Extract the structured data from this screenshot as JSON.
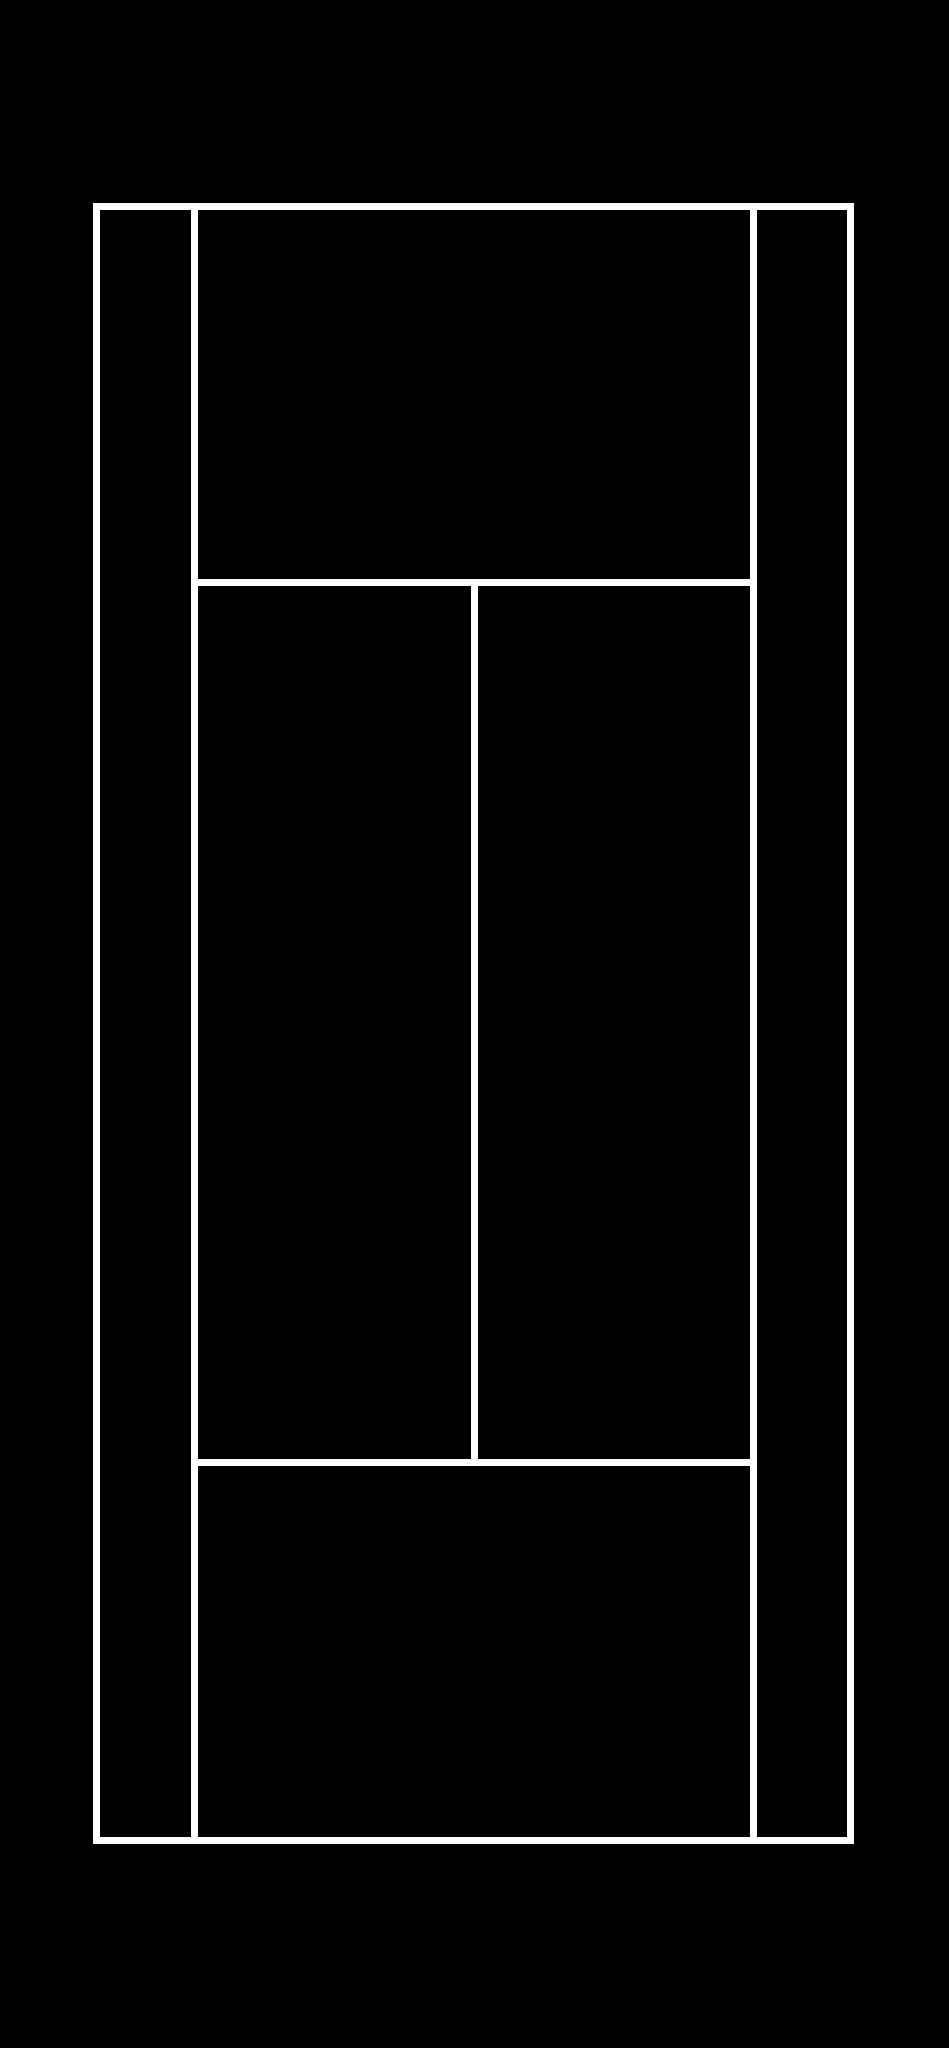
{
  "page": {
    "width": 949,
    "height": 2048,
    "background_color": "#000000"
  },
  "diagram": {
    "kind": "tennis-court-line-diagram",
    "description": "Top-down outline of a tennis court: white lines on a black background, no net line and no center marks",
    "line_color": "#ffffff",
    "line_thickness": 7,
    "court_bounds": {
      "outer_left_x": 93,
      "outer_right_x": 854,
      "outer_top_y": 203,
      "outer_bottom_y": 1844,
      "singles_sideline_left_x": 191,
      "singles_sideline_right_x": 750,
      "service_line_top_y": 579,
      "service_line_bottom_y": 1459,
      "center_service_line_x": 471
    },
    "lines": [
      {
        "name": "baseline-top",
        "x": 93,
        "y": 203,
        "w": 761,
        "h": 7
      },
      {
        "name": "baseline-bottom",
        "x": 93,
        "y": 1837,
        "w": 761,
        "h": 7
      },
      {
        "name": "doubles-sideline-left",
        "x": 93,
        "y": 203,
        "w": 7,
        "h": 1641
      },
      {
        "name": "doubles-sideline-right",
        "x": 847,
        "y": 203,
        "w": 7,
        "h": 1641
      },
      {
        "name": "singles-sideline-left",
        "x": 191,
        "y": 210,
        "w": 7,
        "h": 1627
      },
      {
        "name": "singles-sideline-right",
        "x": 750,
        "y": 210,
        "w": 7,
        "h": 1627
      },
      {
        "name": "service-line-top",
        "x": 198,
        "y": 579,
        "w": 552,
        "h": 7
      },
      {
        "name": "service-line-bottom",
        "x": 198,
        "y": 1459,
        "w": 552,
        "h": 7
      },
      {
        "name": "center-service-line",
        "x": 471,
        "y": 586,
        "w": 7,
        "h": 873
      }
    ]
  }
}
